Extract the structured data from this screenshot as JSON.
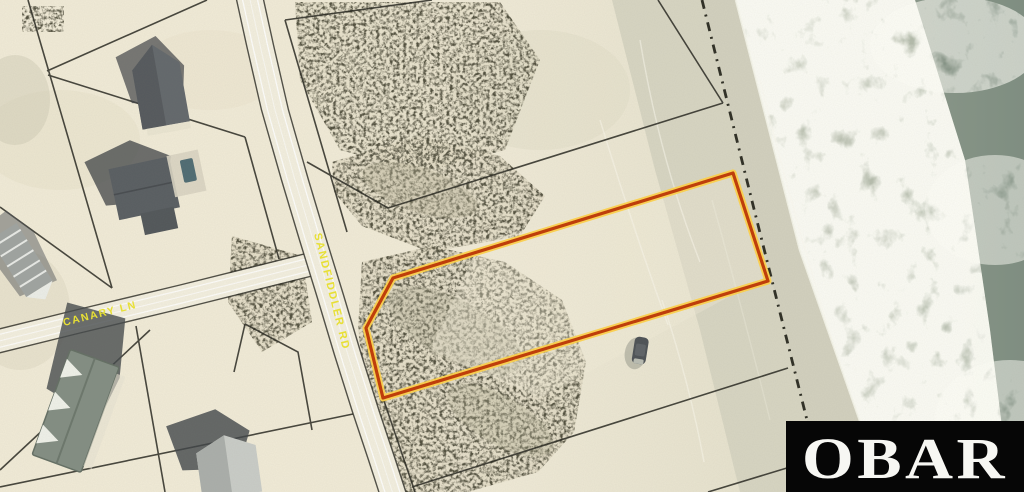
{
  "scene": {
    "type": "aerial-parcel-listing-photo",
    "width": 1024,
    "height": 492
  },
  "map": {
    "road_labels": [
      {
        "id": "sandfiddler-rd",
        "text": "SANDFIDDLER RD"
      },
      {
        "id": "canary-ln",
        "text": "CANARY LN"
      }
    ],
    "label_color": "#ece431",
    "parcel_outline": {
      "outer": "#c03a05",
      "inner": "#ffd24a"
    },
    "boundary_line_color": "#26261f",
    "shoreline_dash_color": "#1b1b12",
    "ocean_color": "#8d9a8d",
    "sand_color": "#f1ebd7"
  },
  "watermark": {
    "text": "OBAR",
    "background": "#060606",
    "color": "#f7f7f3"
  }
}
